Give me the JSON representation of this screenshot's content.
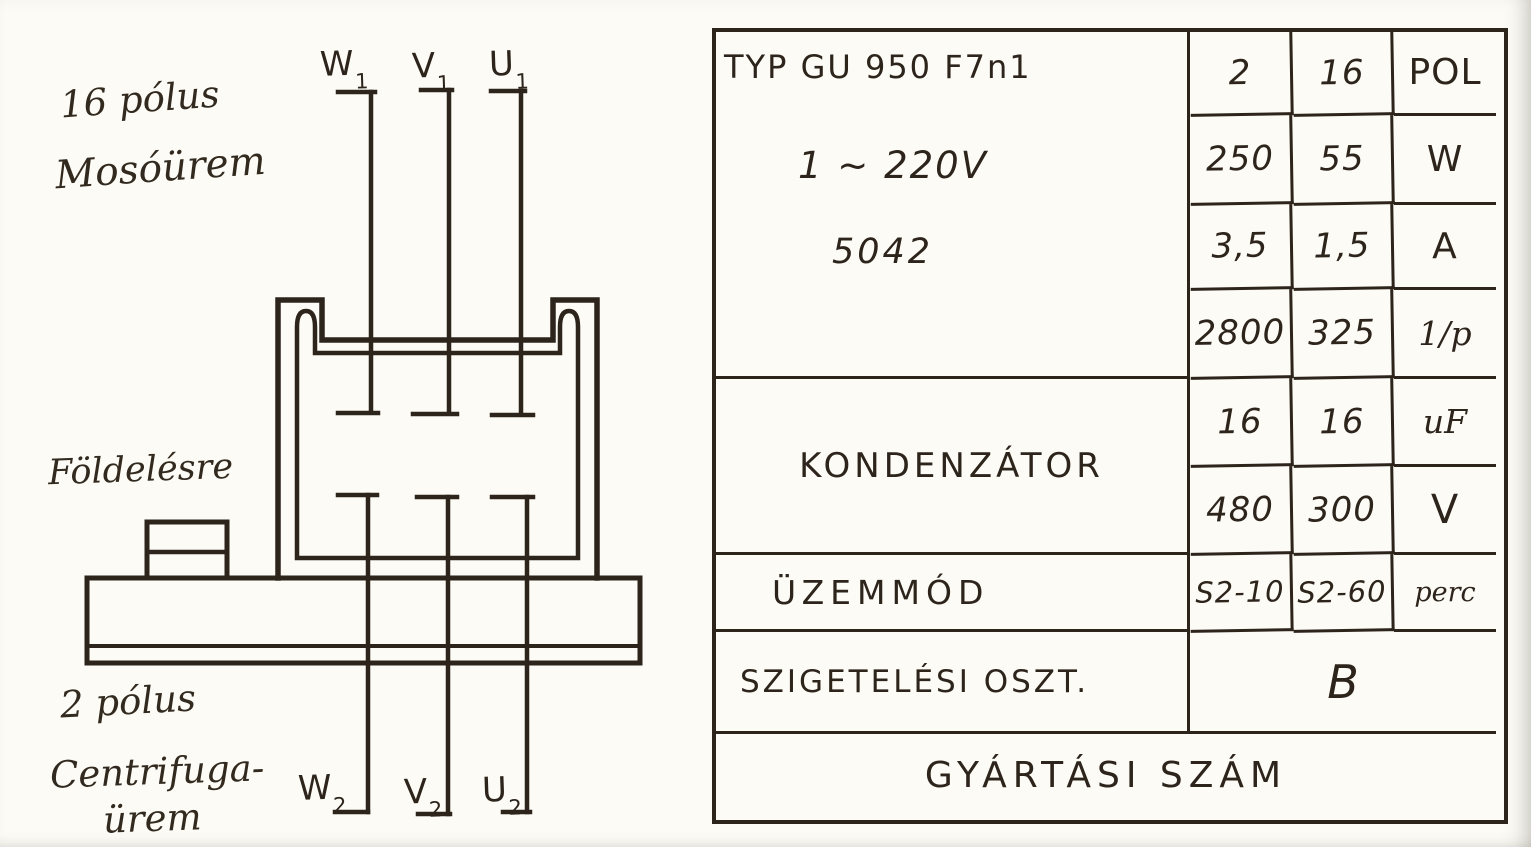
{
  "document": {
    "ink_color": "#2d241b",
    "paper_color": "#fcfbf6"
  },
  "diagram": {
    "annotations": {
      "poles16": "16 pólus",
      "wash_mode": "Mosóürem",
      "grounding": "Földelésre",
      "poles2": "2 pólus",
      "centrifuge_line1": "Centrifuga-",
      "centrifuge_line2": "ürem"
    },
    "terminals_top": [
      {
        "letter": "W",
        "sub": "1"
      },
      {
        "letter": "V",
        "sub": "1"
      },
      {
        "letter": "U",
        "sub": "1"
      }
    ],
    "terminals_bottom": [
      {
        "letter": "W",
        "sub": "2"
      },
      {
        "letter": "V",
        "sub": "2"
      },
      {
        "letter": "U",
        "sub": "2"
      }
    ]
  },
  "table": {
    "type_line1": "TYP GU 950 F7n1",
    "type_line2": "1 ~ 220V",
    "type_line3": "5042",
    "kondenzator_label": "KONDENZÁTOR",
    "uzemmod_label": "ÜZEMMÓD",
    "szigetelesi_label": "SZIGETELÉSI OSZT.",
    "szigetelesi_value": "B",
    "gyartasi_label": "GYÁRTÁSI SZÁM",
    "rows": [
      {
        "col2": "2",
        "col16": "16",
        "unit": "POL"
      },
      {
        "col2": "250",
        "col16": "55",
        "unit": "W"
      },
      {
        "col2": "3,5",
        "col16": "1,5",
        "unit": "A"
      },
      {
        "col2": "2800",
        "col16": "325",
        "unit": "1/p"
      },
      {
        "col2": "16",
        "col16": "16",
        "unit": "uF"
      },
      {
        "col2": "480",
        "col16": "300",
        "unit": "V"
      },
      {
        "col2": "S2-10",
        "col16": "S2-60",
        "unit": "perc"
      }
    ]
  }
}
